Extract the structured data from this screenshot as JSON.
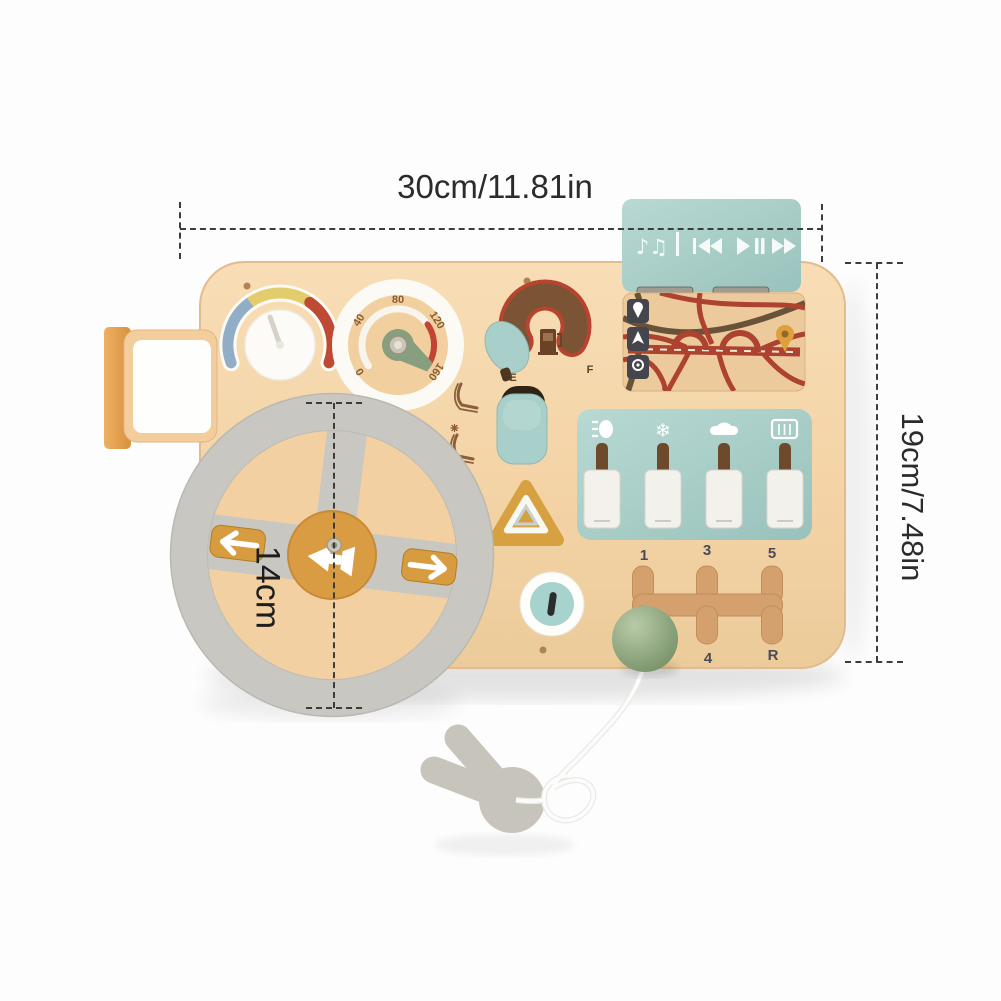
{
  "dimensions": {
    "width_label": "30cm/11.81in",
    "height_label": "19cm/7.48in",
    "wheel_diameter_label": "14cm"
  },
  "speedometer": {
    "ticks": [
      "0",
      "40",
      "80",
      "120",
      "160"
    ]
  },
  "fuel_gauge": {
    "empty_label": "E",
    "full_label": "F"
  },
  "gear_shifter": {
    "top_labels": [
      "1",
      "3",
      "5"
    ],
    "bottom_labels": [
      "4",
      "R"
    ]
  },
  "media_panel": {
    "notes_glyph": "♪♫",
    "icons": [
      "music-notes",
      "rewind",
      "play-pause",
      "fast-forward"
    ]
  },
  "switch_panel": {
    "snowflake_glyph": "❄",
    "icons": [
      "headlight",
      "snowflake",
      "car",
      "rear-defrost"
    ]
  },
  "map_panel": {
    "icons": [
      "location-pin",
      "navigation-arrow",
      "location-ring",
      "destination-pin"
    ]
  },
  "colors": {
    "board_wood": "#f3d5a9",
    "teal": "#a7cdc8",
    "mustard": "#d89c40",
    "sage_green": "#8fa886",
    "accent_red": "#b8432e",
    "wheel_gray": "#c9c7c1",
    "recess_brown": "#7a5434",
    "label_dark": "#4c4a57",
    "dimension_text": "#2b2b2b"
  }
}
